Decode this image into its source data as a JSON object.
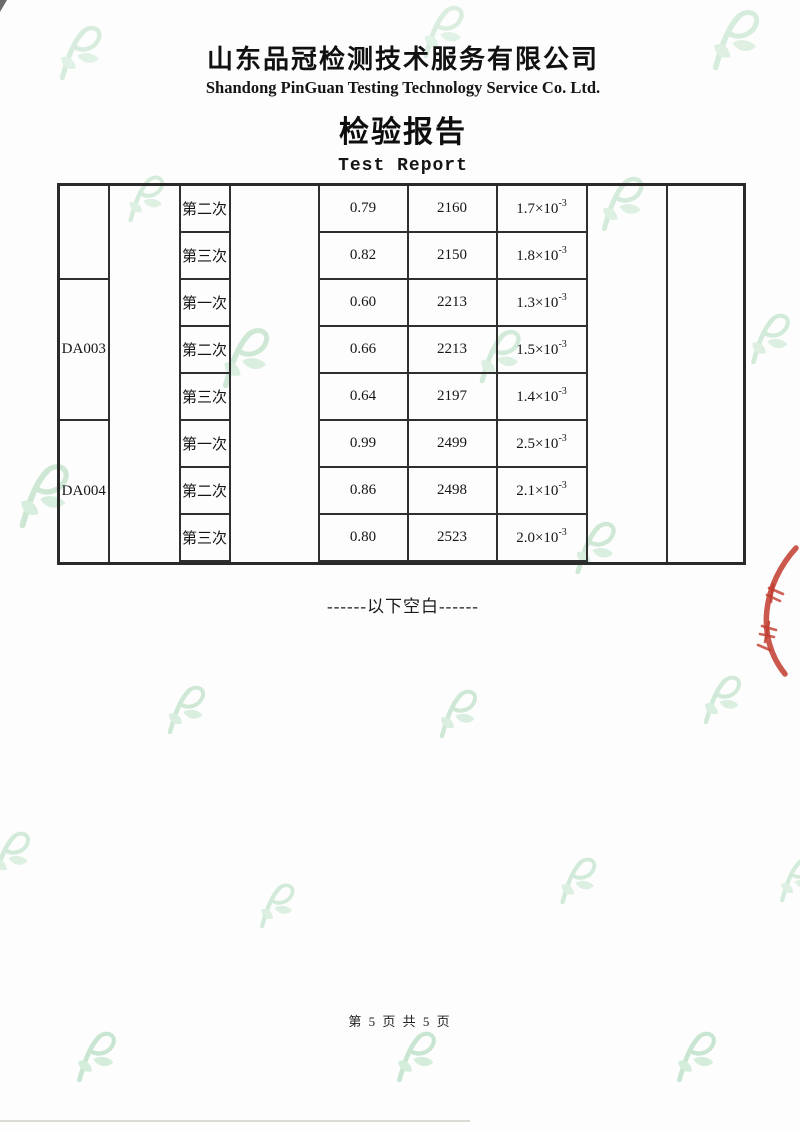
{
  "header": {
    "company_cn": "山东品冠检测技术服务有限公司",
    "company_en": "Shandong PinGuan Testing Technology Service Co. Ltd.",
    "title_cn": "检验报告",
    "title_en": "Test Report"
  },
  "table": {
    "groups": [
      {
        "sample_id": "",
        "rows": [
          {
            "trial": "第二次",
            "v1": "0.79",
            "v2": "2160",
            "sci_coef": "1.7×10",
            "sci_exp": "-3"
          },
          {
            "trial": "第三次",
            "v1": "0.82",
            "v2": "2150",
            "sci_coef": "1.8×10",
            "sci_exp": "-3"
          }
        ]
      },
      {
        "sample_id": "DA003",
        "rows": [
          {
            "trial": "第一次",
            "v1": "0.60",
            "v2": "2213",
            "sci_coef": "1.3×10",
            "sci_exp": "-3"
          },
          {
            "trial": "第二次",
            "v1": "0.66",
            "v2": "2213",
            "sci_coef": "1.5×10",
            "sci_exp": "-3"
          },
          {
            "trial": "第三次",
            "v1": "0.64",
            "v2": "2197",
            "sci_coef": "1.4×10",
            "sci_exp": "-3"
          }
        ]
      },
      {
        "sample_id": "DA004",
        "rows": [
          {
            "trial": "第一次",
            "v1": "0.99",
            "v2": "2499",
            "sci_coef": "2.5×10",
            "sci_exp": "-3"
          },
          {
            "trial": "第二次",
            "v1": "0.86",
            "v2": "2498",
            "sci_coef": "2.1×10",
            "sci_exp": "-3"
          },
          {
            "trial": "第三次",
            "v1": "0.80",
            "v2": "2523",
            "sci_coef": "2.0×10",
            "sci_exp": "-3"
          }
        ]
      }
    ]
  },
  "footer": {
    "below_blank": "------以下空白------",
    "page_number": "第 5 页 共 5 页"
  },
  "icons": {
    "watermark": "pinguan-leaf-p-logo",
    "stamp": "partial-red-seal"
  },
  "colors": {
    "watermark_green_stroke": "#9fd3ae",
    "watermark_green_fill": "#b4dfc0",
    "stamp_red": "#c23b2e",
    "table_border": "#2a2a2a",
    "text": "#1c1c1c",
    "paper": "#fcfdfc"
  }
}
